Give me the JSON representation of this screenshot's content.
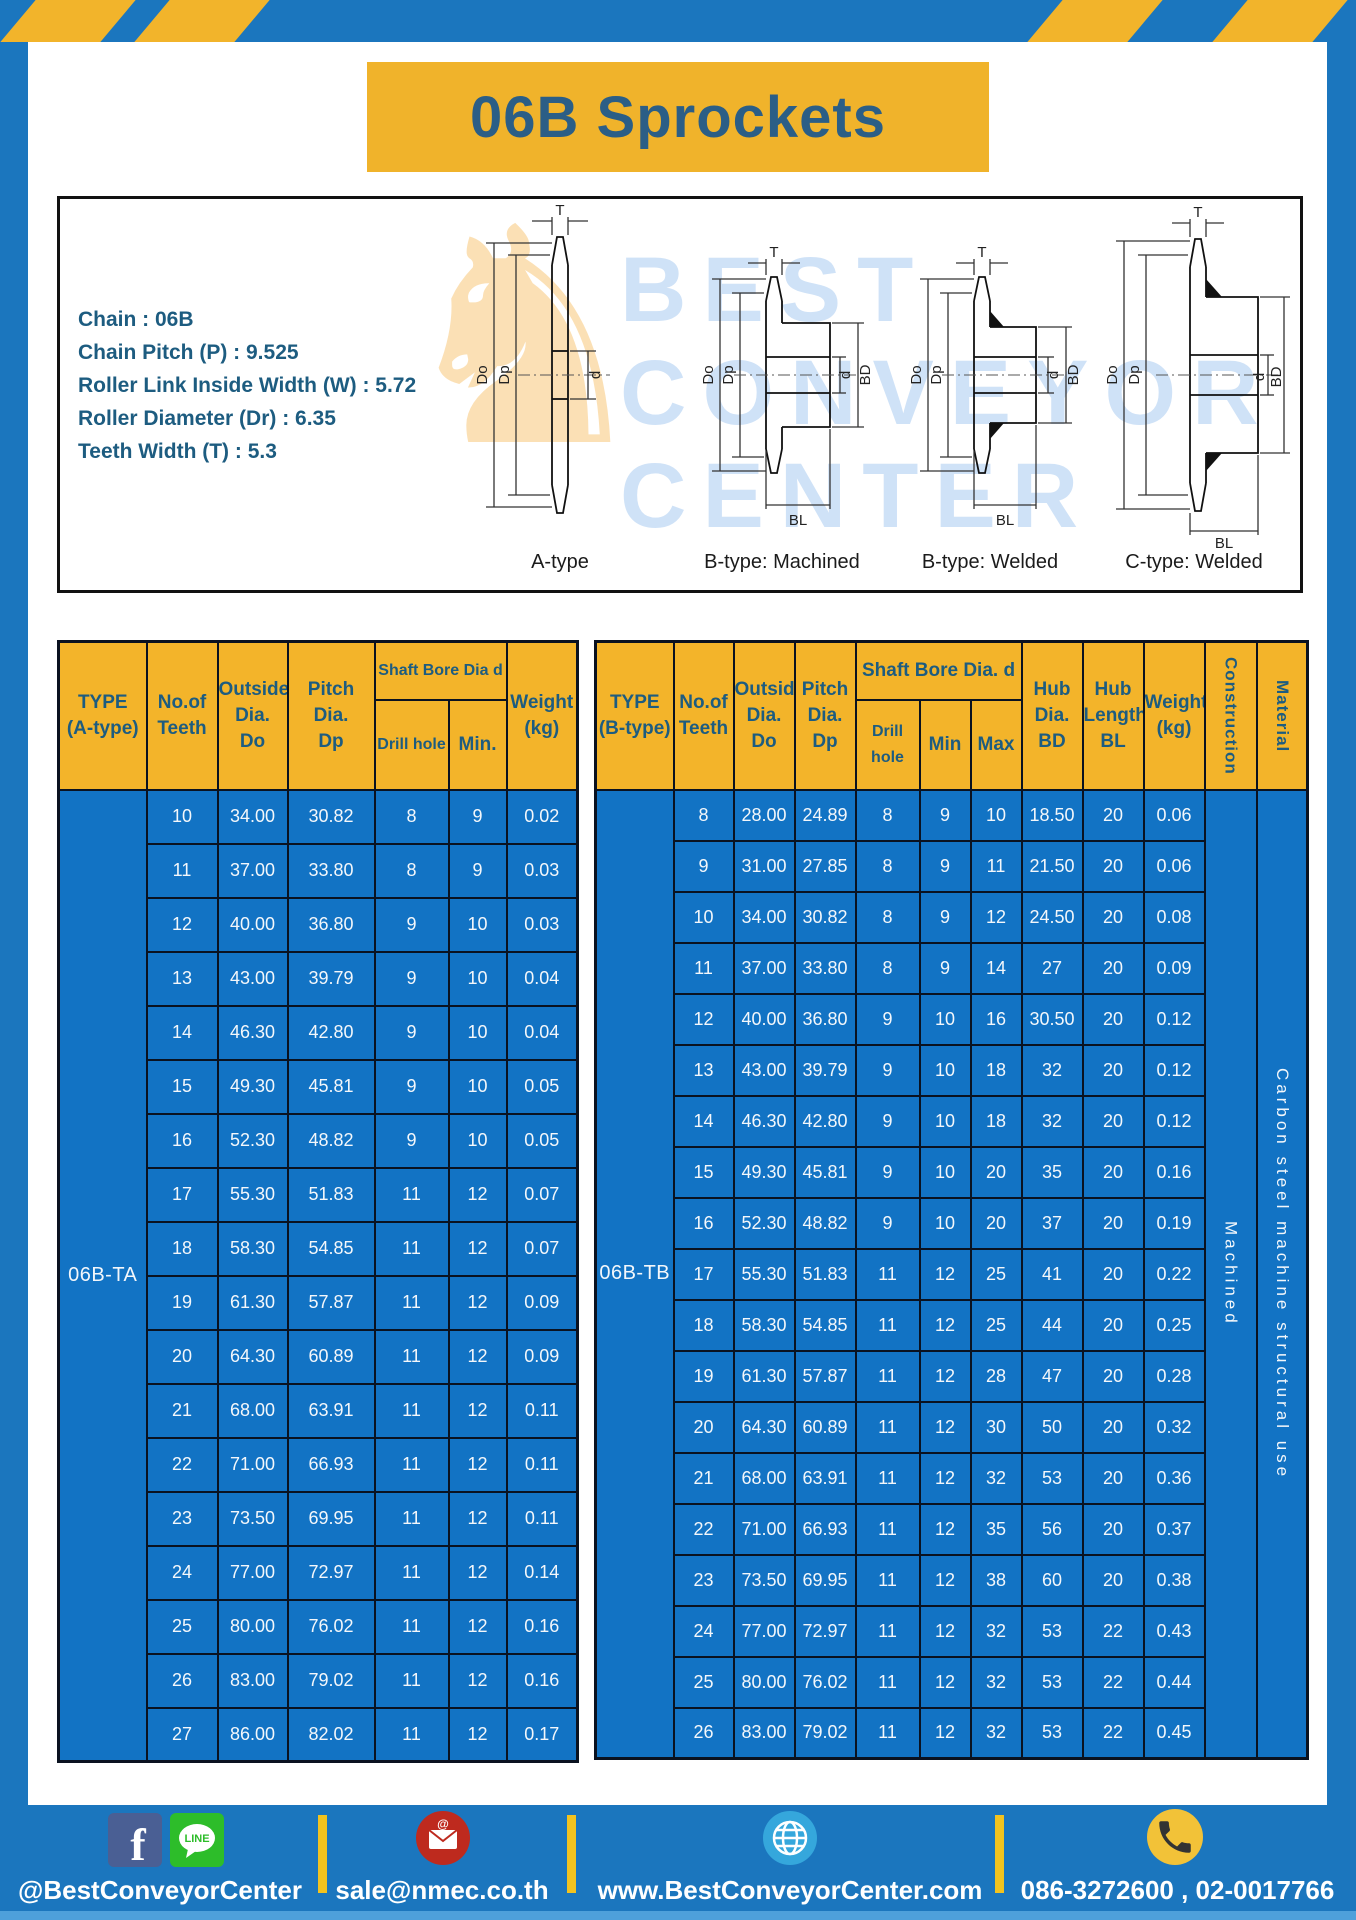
{
  "header": {
    "title": "06B Sprockets"
  },
  "colors": {
    "frame_blue": "#1B76BE",
    "table_cell_blue": "#1273C4",
    "header_yellow": "#F3B42A",
    "title_yellow": "#F0B32B",
    "separator_yellow": "#F2C31F",
    "table_border": "#0A1220",
    "dark_blue_text": "#1D5C80",
    "footer_bottom_strip": "#4EA0DB"
  },
  "specs": {
    "lines": [
      "Chain : 06B",
      "Chain Pitch (P) : 9.525",
      "Roller Link Inside Width (W) : 5.72",
      "Roller Diameter (Dr) : 6.35",
      "Teeth Width (T) : 5.3"
    ]
  },
  "diagrams": {
    "captions": [
      "A-type",
      "B-type: Machined",
      "B-type: Welded",
      "C-type: Welded"
    ],
    "dims": {
      "t": "T",
      "dia_outside": "Do",
      "dia_pitch": "Dp",
      "d": "d",
      "bd": "BD",
      "bl": "BL"
    },
    "watermark_lines": [
      "BEST",
      "CONVEYOR",
      "CENTER"
    ],
    "knight_glyph": "♞"
  },
  "table_a": {
    "type_label": "06B-TA",
    "headers": {
      "type": "TYPE\n(A-type)",
      "teeth": "No.of\nTeeth",
      "outside": "Outside\nDia.\nDo",
      "pitch": "Pitch Dia.\nDp",
      "shaft_bore": "Shaft Bore Dia d",
      "drill_hole": "Drill hole",
      "min": "Min.",
      "weight": "Weight\n(kg)"
    },
    "rows": [
      [
        "10",
        "34.00",
        "30.82",
        "8",
        "9",
        "0.02"
      ],
      [
        "11",
        "37.00",
        "33.80",
        "8",
        "9",
        "0.03"
      ],
      [
        "12",
        "40.00",
        "36.80",
        "9",
        "10",
        "0.03"
      ],
      [
        "13",
        "43.00",
        "39.79",
        "9",
        "10",
        "0.04"
      ],
      [
        "14",
        "46.30",
        "42.80",
        "9",
        "10",
        "0.04"
      ],
      [
        "15",
        "49.30",
        "45.81",
        "9",
        "10",
        "0.05"
      ],
      [
        "16",
        "52.30",
        "48.82",
        "9",
        "10",
        "0.05"
      ],
      [
        "17",
        "55.30",
        "51.83",
        "11",
        "12",
        "0.07"
      ],
      [
        "18",
        "58.30",
        "54.85",
        "11",
        "12",
        "0.07"
      ],
      [
        "19",
        "61.30",
        "57.87",
        "11",
        "12",
        "0.09"
      ],
      [
        "20",
        "64.30",
        "60.89",
        "11",
        "12",
        "0.09"
      ],
      [
        "21",
        "68.00",
        "63.91",
        "11",
        "12",
        "0.11"
      ],
      [
        "22",
        "71.00",
        "66.93",
        "11",
        "12",
        "0.11"
      ],
      [
        "23",
        "73.50",
        "69.95",
        "11",
        "12",
        "0.11"
      ],
      [
        "24",
        "77.00",
        "72.97",
        "11",
        "12",
        "0.14"
      ],
      [
        "25",
        "80.00",
        "76.02",
        "11",
        "12",
        "0.16"
      ],
      [
        "26",
        "83.00",
        "79.02",
        "11",
        "12",
        "0.16"
      ],
      [
        "27",
        "86.00",
        "82.02",
        "11",
        "12",
        "0.17"
      ]
    ]
  },
  "table_b": {
    "type_label": "06B-TB",
    "construction_value": "Machined",
    "material_value": "Carbon steel machine structural use",
    "headers": {
      "type": "TYPE\n(B-type)",
      "teeth": "No.of\nTeeth",
      "outside": "Outside\nDia.\nDo",
      "pitch": "Pitch\nDia.\nDp",
      "shaft_bore": "Shaft Bore Dia. d",
      "drill_hole": "Drill hole",
      "min": "Min",
      "max": "Max",
      "hub_dia": "Hub\nDia.\nBD",
      "hub_length": "Hub\nLength\nBL",
      "weight": "Weight\n(kg)",
      "construction": "Construction",
      "material": "Material"
    },
    "rows": [
      [
        "8",
        "28.00",
        "24.89",
        "8",
        "9",
        "10",
        "18.50",
        "20",
        "0.06"
      ],
      [
        "9",
        "31.00",
        "27.85",
        "8",
        "9",
        "11",
        "21.50",
        "20",
        "0.06"
      ],
      [
        "10",
        "34.00",
        "30.82",
        "8",
        "9",
        "12",
        "24.50",
        "20",
        "0.08"
      ],
      [
        "11",
        "37.00",
        "33.80",
        "8",
        "9",
        "14",
        "27",
        "20",
        "0.09"
      ],
      [
        "12",
        "40.00",
        "36.80",
        "9",
        "10",
        "16",
        "30.50",
        "20",
        "0.12"
      ],
      [
        "13",
        "43.00",
        "39.79",
        "9",
        "10",
        "18",
        "32",
        "20",
        "0.12"
      ],
      [
        "14",
        "46.30",
        "42.80",
        "9",
        "10",
        "18",
        "32",
        "20",
        "0.12"
      ],
      [
        "15",
        "49.30",
        "45.81",
        "9",
        "10",
        "20",
        "35",
        "20",
        "0.16"
      ],
      [
        "16",
        "52.30",
        "48.82",
        "9",
        "10",
        "20",
        "37",
        "20",
        "0.19"
      ],
      [
        "17",
        "55.30",
        "51.83",
        "11",
        "12",
        "25",
        "41",
        "20",
        "0.22"
      ],
      [
        "18",
        "58.30",
        "54.85",
        "11",
        "12",
        "25",
        "44",
        "20",
        "0.25"
      ],
      [
        "19",
        "61.30",
        "57.87",
        "11",
        "12",
        "28",
        "47",
        "20",
        "0.28"
      ],
      [
        "20",
        "64.30",
        "60.89",
        "11",
        "12",
        "30",
        "50",
        "20",
        "0.32"
      ],
      [
        "21",
        "68.00",
        "63.91",
        "11",
        "12",
        "32",
        "53",
        "20",
        "0.36"
      ],
      [
        "22",
        "71.00",
        "66.93",
        "11",
        "12",
        "35",
        "56",
        "20",
        "0.37"
      ],
      [
        "23",
        "73.50",
        "69.95",
        "11",
        "12",
        "38",
        "60",
        "20",
        "0.38"
      ],
      [
        "24",
        "77.00",
        "72.97",
        "11",
        "12",
        "32",
        "53",
        "22",
        "0.43"
      ],
      [
        "25",
        "80.00",
        "76.02",
        "11",
        "12",
        "32",
        "53",
        "22",
        "0.44"
      ],
      [
        "26",
        "83.00",
        "79.02",
        "11",
        "12",
        "32",
        "53",
        "22",
        "0.45"
      ]
    ]
  },
  "footer": {
    "social_text": "@BestConveyorCenter",
    "line_label": "LINE",
    "email_text": "sale@nmec.co.th",
    "website_text": "www.BestConveyorCenter.com",
    "phone_text": "086-3272600 , 02-0017766"
  }
}
